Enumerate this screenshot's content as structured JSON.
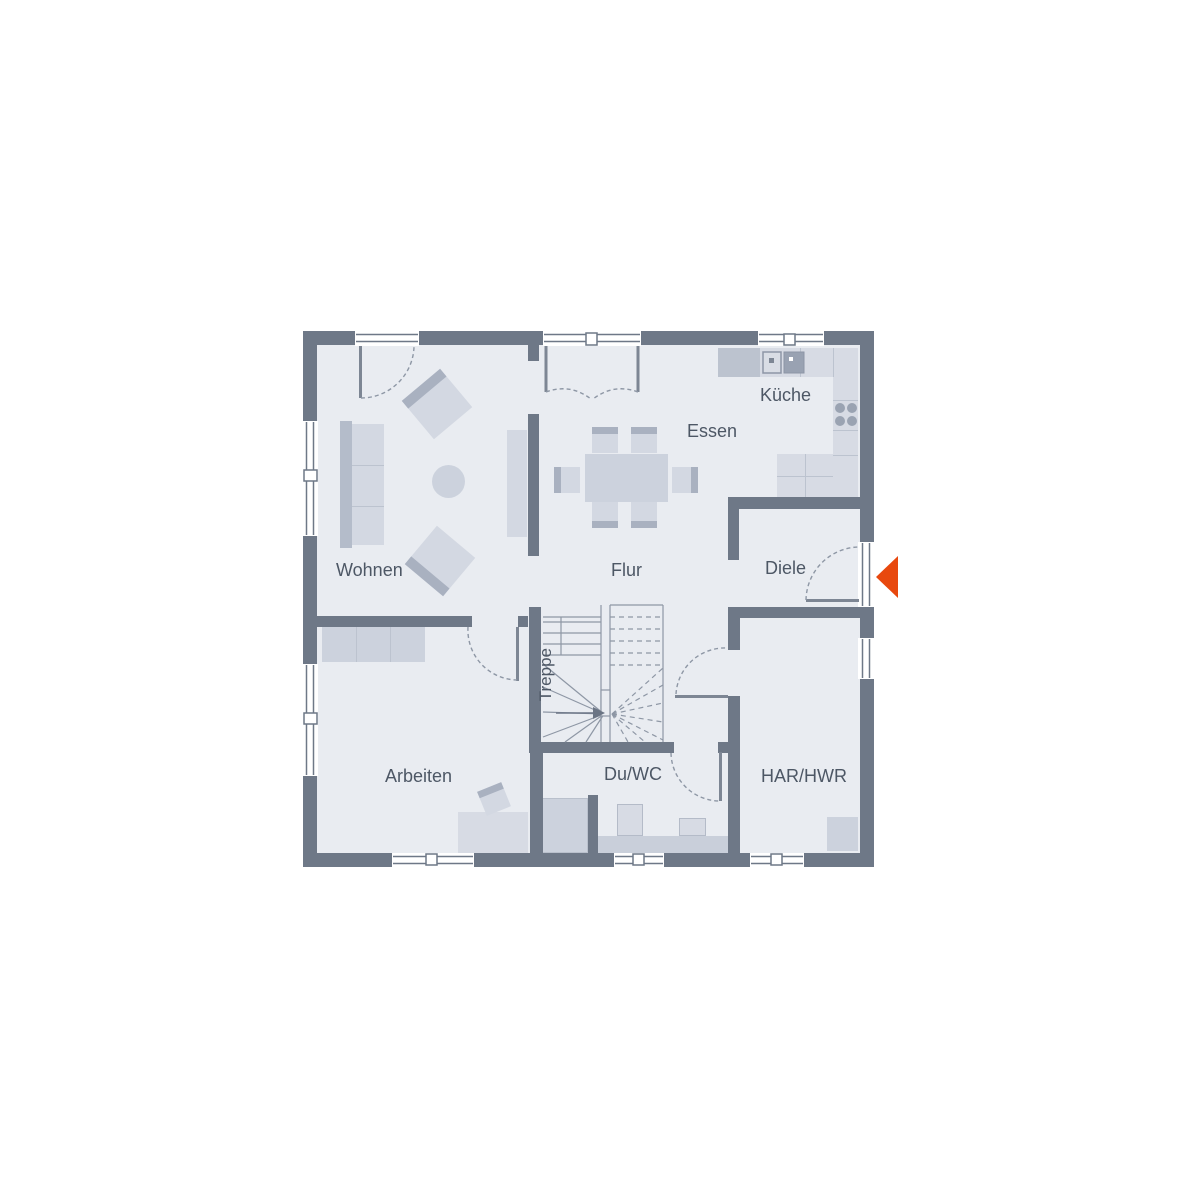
{
  "plan": {
    "type": "floor-plan",
    "language": "de",
    "rooms": {
      "wohnen": {
        "label": "Wohnen"
      },
      "essen": {
        "label": "Essen"
      },
      "kueche": {
        "label": "Küche"
      },
      "flur": {
        "label": "Flur"
      },
      "diele": {
        "label": "Diele"
      },
      "treppe": {
        "label": "Treppe"
      },
      "arbeiten": {
        "label": "Arbeiten"
      },
      "du_wc": {
        "label": "Du/WC"
      },
      "har_hwr": {
        "label": "HAR/HWR"
      }
    },
    "colors": {
      "background": "#ffffff",
      "wall": "#6e7887",
      "floor": "#e9ecf1",
      "furniture_light": "#d3d8e2",
      "furniture_mid": "#ccd2dd",
      "furniture_dark": "#a9b1c0",
      "counter": "#d7dbe4",
      "line": "#8e97a5",
      "label_text": "#4d5765",
      "entrance_arrow": "#e8480e"
    },
    "entrance_marker": {
      "icon": "entrance-arrow",
      "direction": "left"
    }
  }
}
